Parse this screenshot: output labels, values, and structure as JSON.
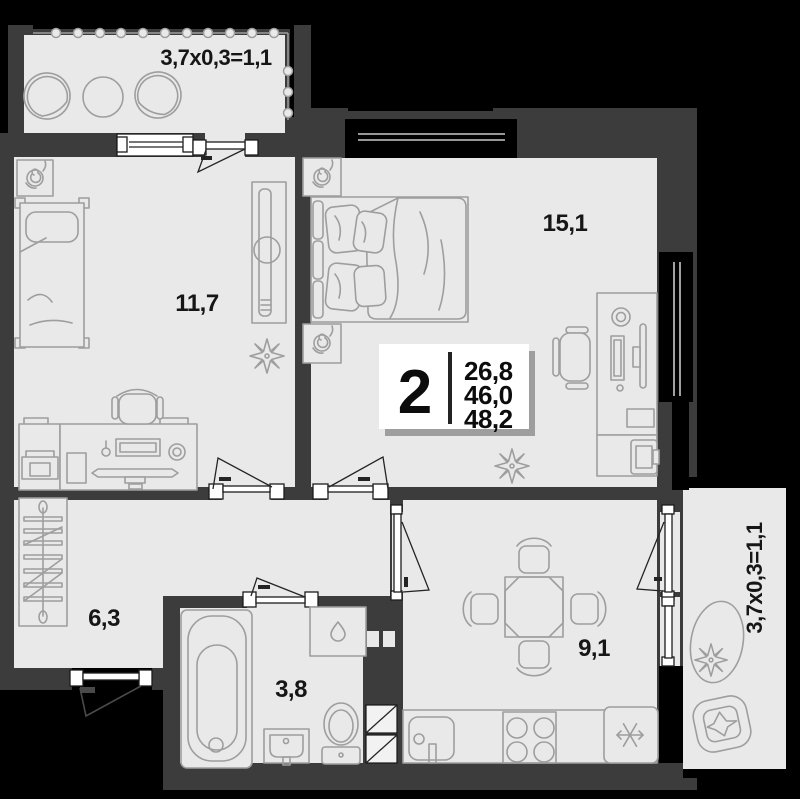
{
  "colors": {
    "background": "#000000",
    "wall": "#3c3c3c",
    "floor": "#e9e9e9",
    "furniture": "#9e9e9e",
    "glass": "#c9c9c9",
    "text": "#161616",
    "white": "#ffffff"
  },
  "plan": {
    "info_plate": {
      "rooms_count": "2",
      "area_living": "26,8",
      "area_main": "46,0",
      "area_total": "48,2"
    },
    "labels": {
      "bedroom": "11,7",
      "living": "15,1",
      "hallway": "6,3",
      "bathroom": "3,8",
      "kitchen": "9,1",
      "balcony_top": "3,7x0,3=1,1",
      "balcony_right": "3,7x0,3=1,1"
    }
  }
}
